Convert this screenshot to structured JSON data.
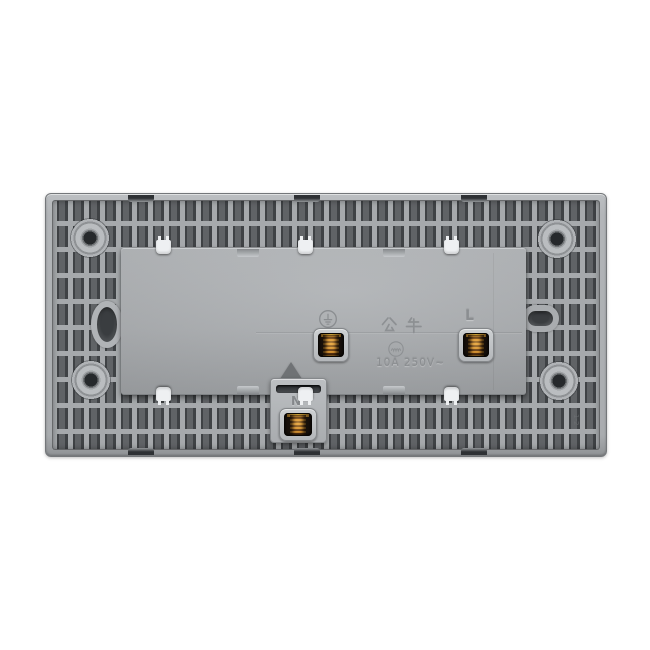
{
  "caption": "Rear view of a gray plastic wall-socket mechanism with three wiring terminals",
  "labels": {
    "brand": "公牛",
    "rating": "10A 250V~",
    "terminal_live": "L",
    "terminal_neutral": "N",
    "earth_symbol": "earth-ground",
    "mold_mark": "1-2"
  },
  "colors": {
    "background": "#ffffff",
    "frame_light": "#b2b5b8",
    "frame_rib": "#a6a9ac",
    "recess_dark": "#3f4245",
    "module_gray": "#a8abae",
    "clip_white": "#eef0f2",
    "copper": "#cf8c2e",
    "copper_dark": "#5a3311",
    "engraved_text": "#8b8e91"
  }
}
